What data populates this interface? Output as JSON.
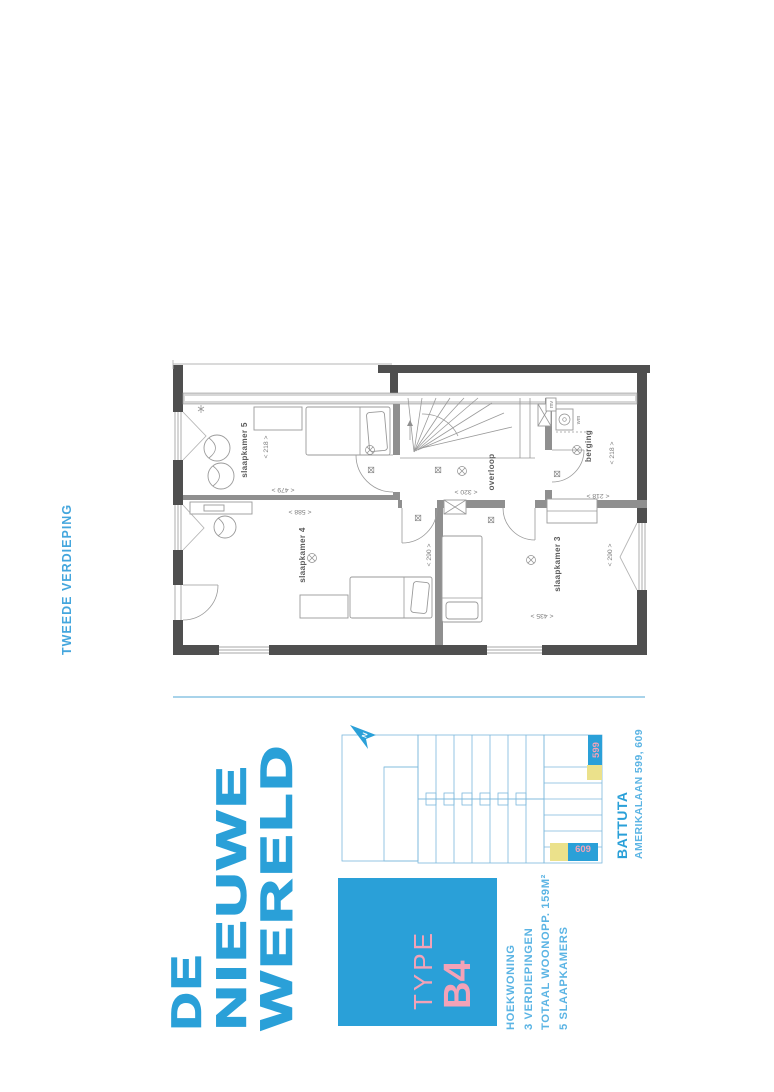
{
  "header": {
    "title": "TWEEDE VERDIEPING"
  },
  "floorplan": {
    "rooms": {
      "slaapkamer5": "slaapkamer 5",
      "slaapkamer4": "slaapkamer 4",
      "slaapkamer3": "slaapkamer 3",
      "overloop": "overloop",
      "berging": "berging",
      "mv": "mv",
      "wm": "wm"
    },
    "dimensions": {
      "room5_width": "< 218 >",
      "room5_depth": "< 479 >",
      "room4_width": "< 588 >",
      "room4_depth": "< 290 >",
      "overloop_width": "< 320 >",
      "berging_width": "< 218 >",
      "berging_depth": "< 218 >",
      "room3_width": "< 435 >",
      "room3_depth": "< 290 >"
    }
  },
  "branding": {
    "logo_lines": [
      "DE",
      "NIEUWE",
      "WERELD"
    ]
  },
  "site_plan": {
    "north_label": "N",
    "markers": {
      "m599": "599",
      "m609": "609"
    }
  },
  "project": {
    "name": "BATTUTA",
    "address": "AMERIKALAAN 599, 609"
  },
  "type_card": {
    "label": "TYPE",
    "code": "B4"
  },
  "specs": {
    "lines": [
      "HOEKWONING",
      "3 VERDIEPINGEN",
      "TOTAAL WOONOPP. 159M²",
      "5 SLAAPKAMERS"
    ]
  },
  "colors": {
    "brand_blue": "#2aa0d8",
    "sky_blue": "#5bb4e4",
    "header_blue": "#44a6dd",
    "accent_pink": "#f3a2b7",
    "unit_yellow": "#ebe18b",
    "siteplan_line": "#7cb8dd",
    "divider_blue": "#a8d3ea",
    "wall_dark": "#4f4f4f",
    "wall_mid": "#8f8f8f",
    "plan_line": "#9a9a9a",
    "plan_text": "#7d7d7d",
    "label_text": "#5c5c5c"
  }
}
